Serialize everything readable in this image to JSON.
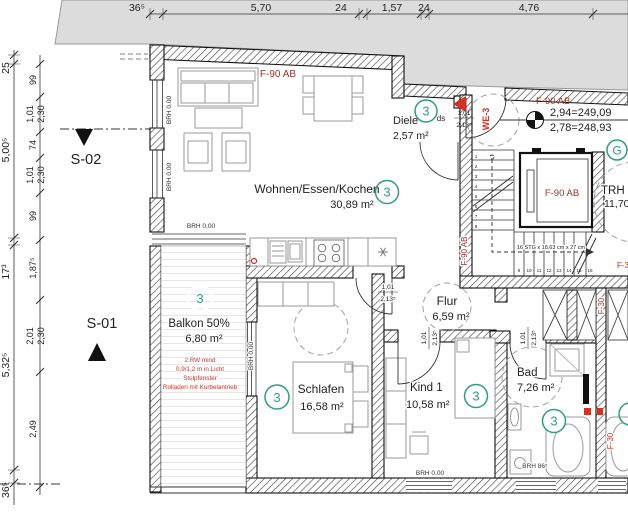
{
  "dimensions": {
    "top": [
      "36⁵",
      "5,70",
      "24",
      "1,57",
      "24",
      "4,76"
    ],
    "left_outer": [
      "25",
      "5,00⁵",
      "17³",
      "5,32⁵",
      "36⁵"
    ],
    "left_inner": [
      {
        "a": "99"
      },
      {
        "a": "1,01",
        "b": "2,30"
      },
      {
        "a": "74"
      },
      {
        "a": "1,01",
        "b": "2,30"
      },
      {
        "a": "99"
      },
      {
        "a": "1,87⁵"
      },
      {
        "a": "2,01",
        "b": "2,30"
      },
      {
        "a": "2,49"
      }
    ]
  },
  "rooms": {
    "wohnen": {
      "name": "Wohnen/Essen/Kochen",
      "area": "30,89 m²",
      "unit": "3"
    },
    "diele": {
      "name": "Diele",
      "area": "2,57 m²",
      "unit": "3"
    },
    "balkon": {
      "name": "Balkon 50%",
      "area": "6,80 m²",
      "unit": "3"
    },
    "schlafen": {
      "name": "Schlafen",
      "area": "16,58 m²",
      "unit": "3"
    },
    "kind": {
      "name": "Kind 1",
      "area": "10,58 m²",
      "unit": "3"
    },
    "flur": {
      "name": "Flur",
      "area": "6,59 m²"
    },
    "bad": {
      "name": "Bad",
      "area": "7,26 m²",
      "unit": "3"
    },
    "trh": {
      "name": "TRH",
      "area": "11,70"
    }
  },
  "stair": {
    "note": "16 STG x 18,63 cm x 27 cm",
    "steps": [
      "1",
      "2",
      "3",
      "4",
      "5",
      "6",
      "7",
      "8",
      "9",
      "10",
      "11",
      "12",
      "13",
      "14",
      "15",
      "16"
    ]
  },
  "door": {
    "w": "1,01",
    "h": "2,13⁵"
  },
  "brh": {
    "zero": "BRH 0,00",
    "bath": "BRH 86⁵"
  },
  "fire": {
    "f90": "F-90 AB",
    "f30": "F-30"
  },
  "entry": {
    "unit": "WE-3",
    "ds": "ds"
  },
  "levels": {
    "upper": "2,94=249,09",
    "lower": "2,78=248,93"
  },
  "sections": {
    "s1": "S-01",
    "s2": "S-02"
  },
  "balcony_note": [
    "2.RW mind",
    "0,9/1,2 m in Licht",
    "Stulpfenster",
    "Rolladen mit Kurbelantrieb"
  ],
  "g": "G",
  "colors": {
    "green": "#2f9e7d",
    "red": "#d83020",
    "dark_red": "#993328",
    "site_gray": "#dcdcdc"
  }
}
